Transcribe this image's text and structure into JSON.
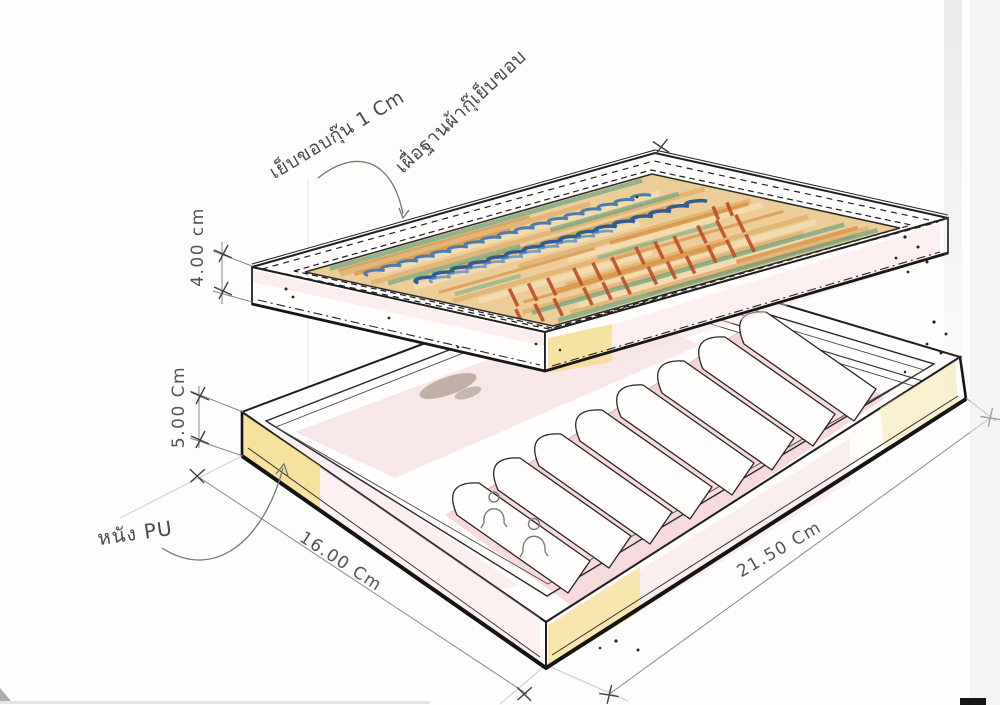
{
  "page": {
    "title": "Jewelry box design sketch (exploded lid and ring tray)"
  },
  "annotations": {
    "binding_note": "เย็บขอบกุ๊น 1 Cm",
    "fabric_note": "เผื่อฐานผ้ากุ๊เย็บขอบ",
    "material_note": "หนัง PU"
  },
  "dimensions": {
    "lid_height": "4.00 cm",
    "tray_height": "5.00 Cm",
    "tray_width": "16.00 Cm",
    "tray_length": "21.50 Cm"
  },
  "palette": {
    "paper": "#fdfdfc",
    "ink": "#1f1f1e",
    "pencil": "#8a8a8a",
    "pink_wash": "#f2d1d5",
    "yellow_wash": "#f4dc8d",
    "fabric_base": "#edcd97",
    "fabric_orange": "#d98f41",
    "fabric_green": "#55a083",
    "fabric_blue": "#2e5c94",
    "fabric_red": "#bd4c28",
    "shadow_brown": "#8c7a67"
  }
}
